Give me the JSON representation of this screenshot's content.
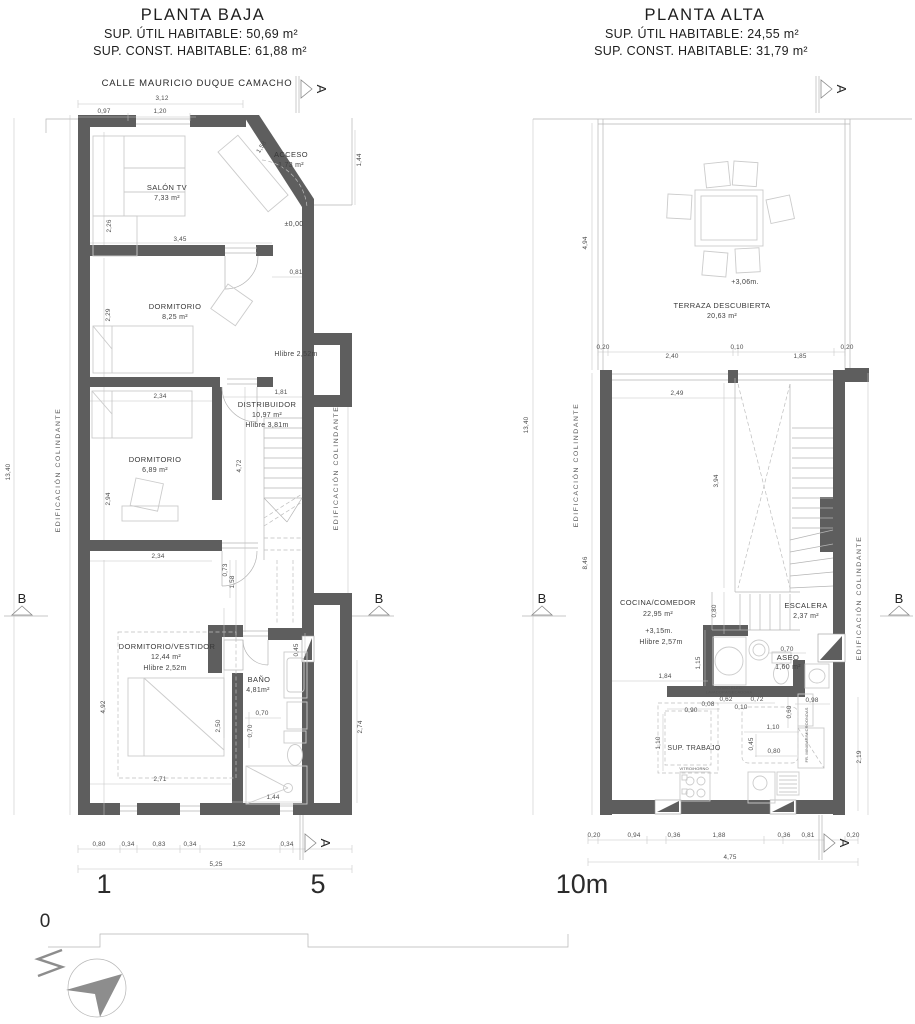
{
  "sheet": {
    "section_a": "A",
    "section_b": "B",
    "scale_bar": {
      "zero": "0",
      "one": "1",
      "five": "5",
      "ten": "10m"
    }
  },
  "baja": {
    "title": "PLANTA BAJA",
    "sup_util": "SUP. ÚTIL HABITABLE: 50,69 m²",
    "sup_const": "SUP. CONST. HABITABLE: 61,88 m²",
    "street": "CALLE MAURICIO DUQUE CAMACHO",
    "colindante_left": "EDIFICACIÓN COLINDANTE",
    "colindante_right": "EDIFICACIÓN COLINDANTE",
    "level_entry": "±0,00",
    "rooms": {
      "salon": {
        "name": "SALÓN TV",
        "area": "7,33 m²"
      },
      "acceso": {
        "name": "ACCESO",
        "area": "1,73 m²"
      },
      "dorm1": {
        "name": "DORMITORIO",
        "area": "8,25 m²",
        "hlibre": "Hlibre 2,52m"
      },
      "dorm2": {
        "name": "DORMITORIO",
        "area": "6,89 m²"
      },
      "distribuidor": {
        "name": "DISTRIBUIDOR",
        "area": "10,97 m²",
        "hlibre": "Hlibre 3,81m"
      },
      "vestidor": {
        "name": "DORMITORIO/VESTIDOR",
        "area": "12,44 m²",
        "hlibre": "Hlibre 2,52m"
      },
      "bano": {
        "name": "BAÑO",
        "area": "4,81m²"
      }
    },
    "dims": {
      "top_total": "3,12",
      "top_a": "0,97",
      "top_b": "1,20",
      "right_v": "1,44",
      "diag": "1,58",
      "salon_w": "3,45",
      "salon_h": "2,26",
      "door": "0,81",
      "dorm1_h": "2,29",
      "dorm1_w": "2,34",
      "dist_w": "1,81",
      "dist_h": "4,72",
      "dorm2_h": "2,94",
      "dorm2_w": "2,34",
      "p1": "0,73",
      "p2": "1,58",
      "vest_h": "4,92",
      "vest_v": "2,50",
      "bano_a": "0,70",
      "bano_b": "0,70",
      "w45": "0,45",
      "right_low": "2,74",
      "vest_w": "2,71",
      "bano_w": "1,44",
      "bottom": [
        "0,80",
        "0,34",
        "0,83",
        "0,34",
        "1,52",
        "0,34"
      ],
      "bottom_total": "5,25",
      "left_total": "13,40"
    }
  },
  "alta": {
    "title": "PLANTA ALTA",
    "sup_util": "SUP. ÚTIL HABITABLE: 24,55 m²",
    "sup_const": "SUP. CONST. HABITABLE: 31,79 m²",
    "colindante_left": "EDIFICACIÓN COLINDANTE",
    "colindante_right": "EDIFICACIÓN COLINDANTE",
    "rooms": {
      "terraza": {
        "name": "TERRAZA DESCUBIERTA",
        "area": "20,63 m²",
        "level": "+3,06m."
      },
      "cocina": {
        "name": "COCINA/COMEDOR",
        "area": "22,95 m²",
        "level": "+3,15m.",
        "hlibre": "Hlibre 2,57m"
      },
      "escalera": {
        "name": "ESCALERA",
        "area": "2,37 m²"
      },
      "aseo": {
        "name": "ASEO",
        "area": "1,60 m²",
        "width": "0,70"
      },
      "trabajo": {
        "name": "SUP. TRABAJO"
      }
    },
    "appliances": {
      "termo": "TERMO ELEC.",
      "lavadora": "LAVADORA/SECADORA",
      "vitro": "VITRO/HORNO",
      "minibar": "FR. MINIBAR/MICROONDAS"
    },
    "dims": {
      "terr_h": "4,94",
      "terr_row": [
        "0,20",
        "2,40",
        "0,10",
        "1,85",
        "0,20"
      ],
      "left_total": "13,40",
      "low_h": "8,46",
      "cocina_w": "2,49",
      "stair_h": "3,94",
      "stair_b": "0,80",
      "k1": "1,84",
      "k2": "1,15",
      "k3": "0,62",
      "k4": "0,10",
      "k5": "0,72",
      "k6": "0,98",
      "k7": "0,90",
      "k8": "0,08",
      "k9": "0,60",
      "k10": "1,10",
      "k11": "0,45",
      "k12": "0,80",
      "k13": "1,10",
      "right_v": "2,19",
      "bottom": [
        "0,20",
        "0,94",
        "0,36",
        "1,88",
        "0,36",
        "0,81",
        "0,20"
      ],
      "bottom_total": "4,75"
    }
  }
}
